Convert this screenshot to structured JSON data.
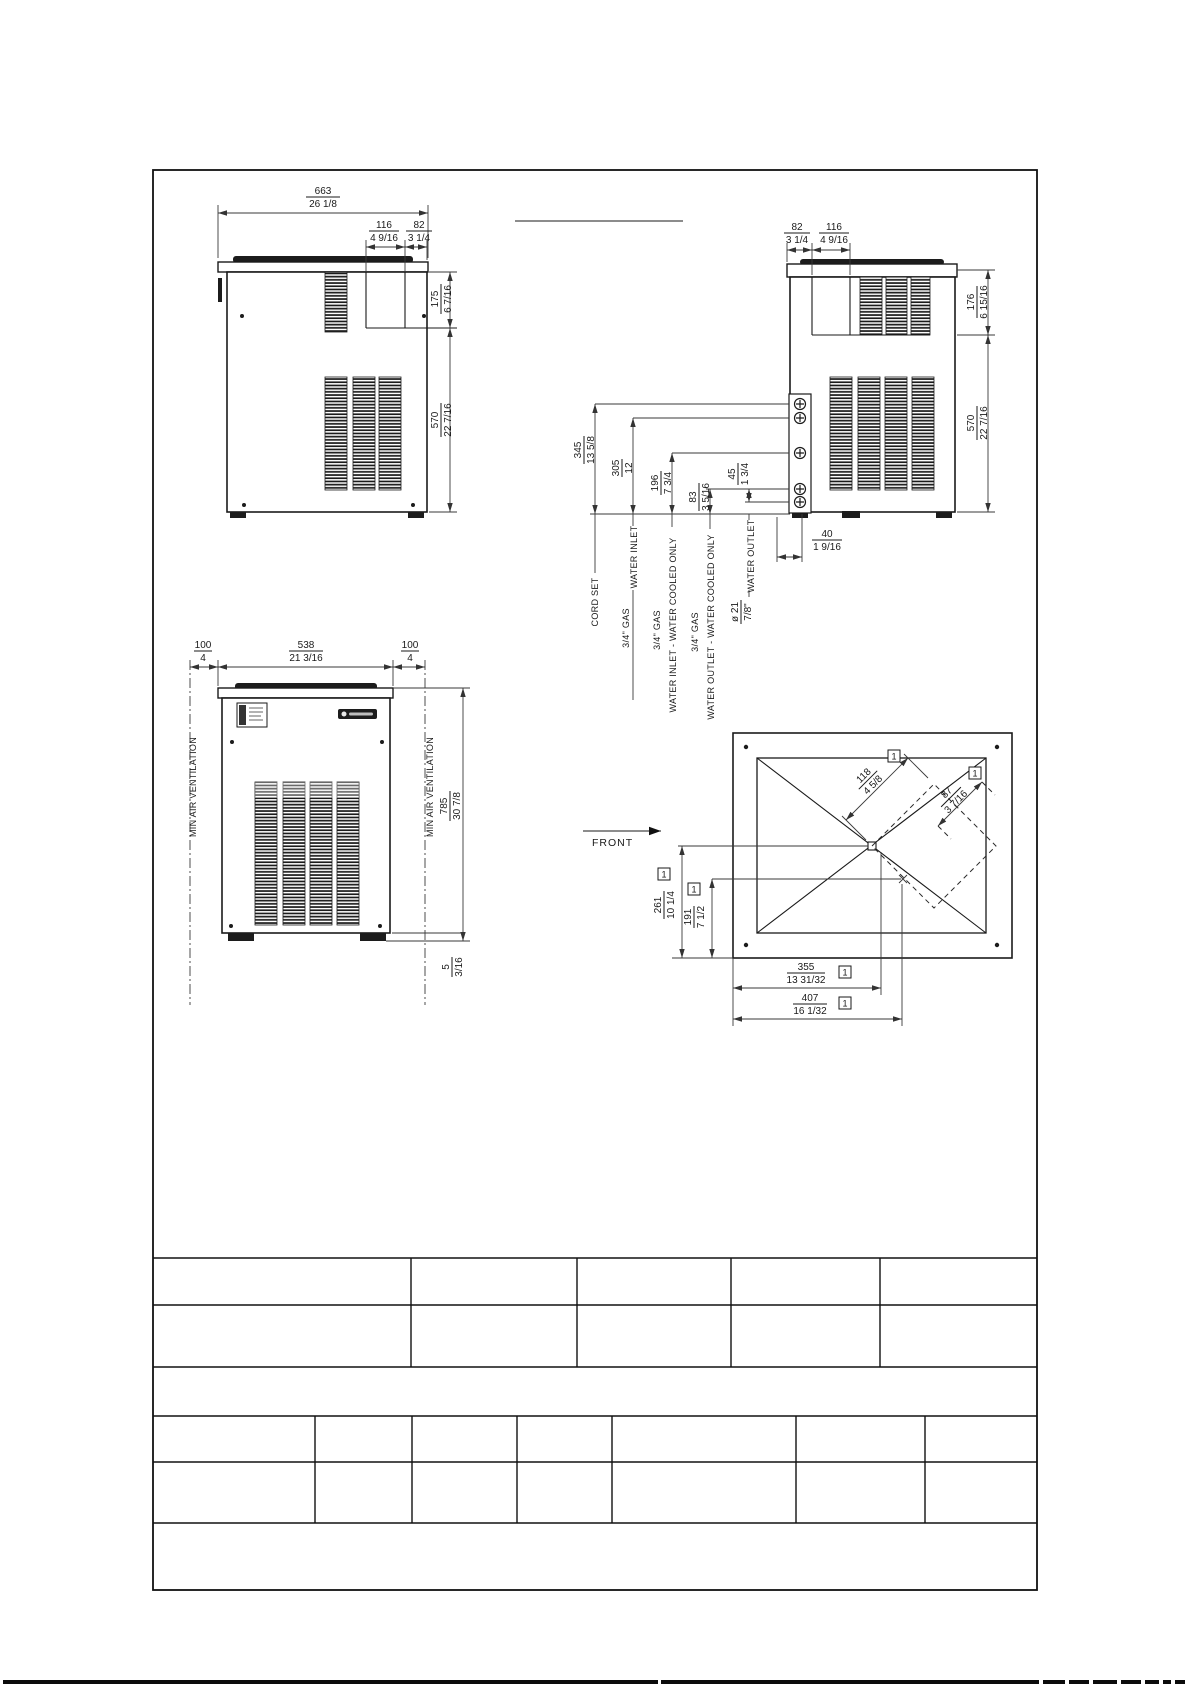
{
  "side_view": {
    "dims": {
      "width": {
        "mm": "663",
        "in": "26 1/8"
      },
      "grille_w": {
        "mm": "116",
        "in": "4 9/16"
      },
      "grille_off": {
        "mm": "82",
        "in": "3 1/4"
      },
      "top_h": {
        "mm": "175",
        "in": "6 7/16"
      },
      "body_h": {
        "mm": "570",
        "in": "22 7/16"
      }
    }
  },
  "back_view": {
    "dims": {
      "grille_off": {
        "mm": "82",
        "in": "3 1/4"
      },
      "grille_w": {
        "mm": "116",
        "in": "4 9/16"
      },
      "top_h": {
        "mm": "176",
        "in": "6 15/16"
      },
      "body_h": {
        "mm": "570",
        "in": "22 7/16"
      },
      "cord": {
        "mm": "345",
        "in": "13 5/8"
      },
      "inlet": {
        "mm": "305",
        "in": "12"
      },
      "wc_inlet": {
        "mm": "196",
        "in": "7 3/4"
      },
      "wc_outlet": {
        "mm": "83",
        "in": "3 5/16"
      },
      "outlet_gap": {
        "mm": "45",
        "in": "1 3/4"
      },
      "side_off": {
        "mm": "40",
        "in": "1 9/16"
      },
      "drain": {
        "mm": "ø 21",
        "in": "7/8\""
      }
    },
    "labels": {
      "cord_set": "CORD SET",
      "gas": "3/4\" GAS",
      "water_inlet": "WATER INLET",
      "water_inlet_wc": "WATER INLET - WATER COOLED ONLY",
      "water_outlet_wc": "WATER OUTLET - WATER COOLED ONLY",
      "water_outlet": "WATER OUTLET"
    }
  },
  "front_view": {
    "dims": {
      "clearance_l": {
        "mm": "100",
        "in": "4"
      },
      "width": {
        "mm": "538",
        "in": "21 3/16"
      },
      "clearance_r": {
        "mm": "100",
        "in": "4"
      },
      "height": {
        "mm": "785",
        "in": "30 7/8"
      },
      "feet": {
        "mm": "5",
        "in": "3/16"
      }
    },
    "labels": {
      "min_air_left": "MIN AIR VENTILATION",
      "min_air_right": "MIN AIR VENTILATION"
    }
  },
  "plan_view": {
    "labels": {
      "front_label": "FRONT",
      "note_ref": "1"
    },
    "dims": {
      "chute_w": {
        "mm": "118",
        "in": "4 5/8"
      },
      "chute_d": {
        "mm": "87",
        "in": "3 7/16"
      },
      "center_from_rear": {
        "mm": "261",
        "in": "10 1/4"
      },
      "chute_from_rear": {
        "mm": "191",
        "in": "7 1/2"
      },
      "center_from_side": {
        "mm": "355",
        "in": "13 31/32"
      },
      "chute_from_side": {
        "mm": "407",
        "in": "16 1/32"
      }
    }
  }
}
